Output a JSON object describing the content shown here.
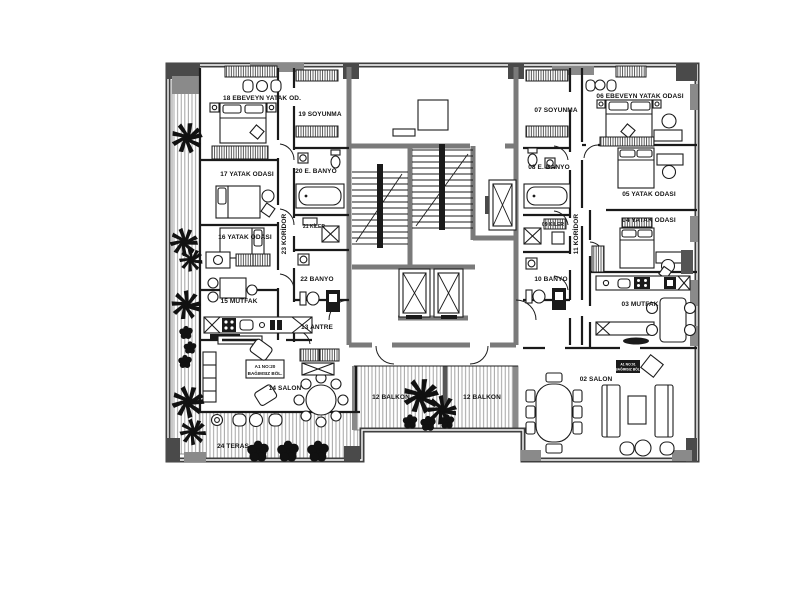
{
  "plan": {
    "colors": {
      "background": "#ffffff",
      "ink": "#1c1c1c",
      "outer_wall": "#3f3f3f",
      "core_wall": "#7a7a7a",
      "column": "#4a4a4a",
      "hatch": "#9a9a9a"
    },
    "rooms": {
      "r18": "18 EBEVEYN YATAK OD.",
      "r19": "19 SOYUNMA",
      "r20": "20 E. BANYO",
      "r17": "17 YATAK ODASI",
      "r16": "16 YATAK ODASI",
      "r21": "21 KİLER",
      "r22": "22 BANYO",
      "r23": "23 KORİDOR",
      "r15": "15 MUTFAK",
      "r13": "13 ANTRE",
      "r14": "14 SALON",
      "r24": "24 TERAS",
      "r12L": "12 BALKON",
      "r12R": "12 BALKON",
      "r06": "06 EBEVEYN YATAK ODASI",
      "r07": "07 SOYUNMA",
      "r08": "08 E. BANYO",
      "r05": "05 YATAK ODASI",
      "r04": "04 YATAK ODASI",
      "r09": "09 KİLER",
      "r10": "10 BANYO",
      "r11": "11 KORİDOR",
      "r03": "03 MUTFAK",
      "r02": "02 SALON"
    },
    "badges": {
      "left": {
        "line1": "A1 NO:20",
        "line2": "BAĞIMSIZ BÖL."
      },
      "right": {
        "line1": "A1 NO:01",
        "line2": "BAĞIMSIZ BÖL."
      }
    }
  }
}
